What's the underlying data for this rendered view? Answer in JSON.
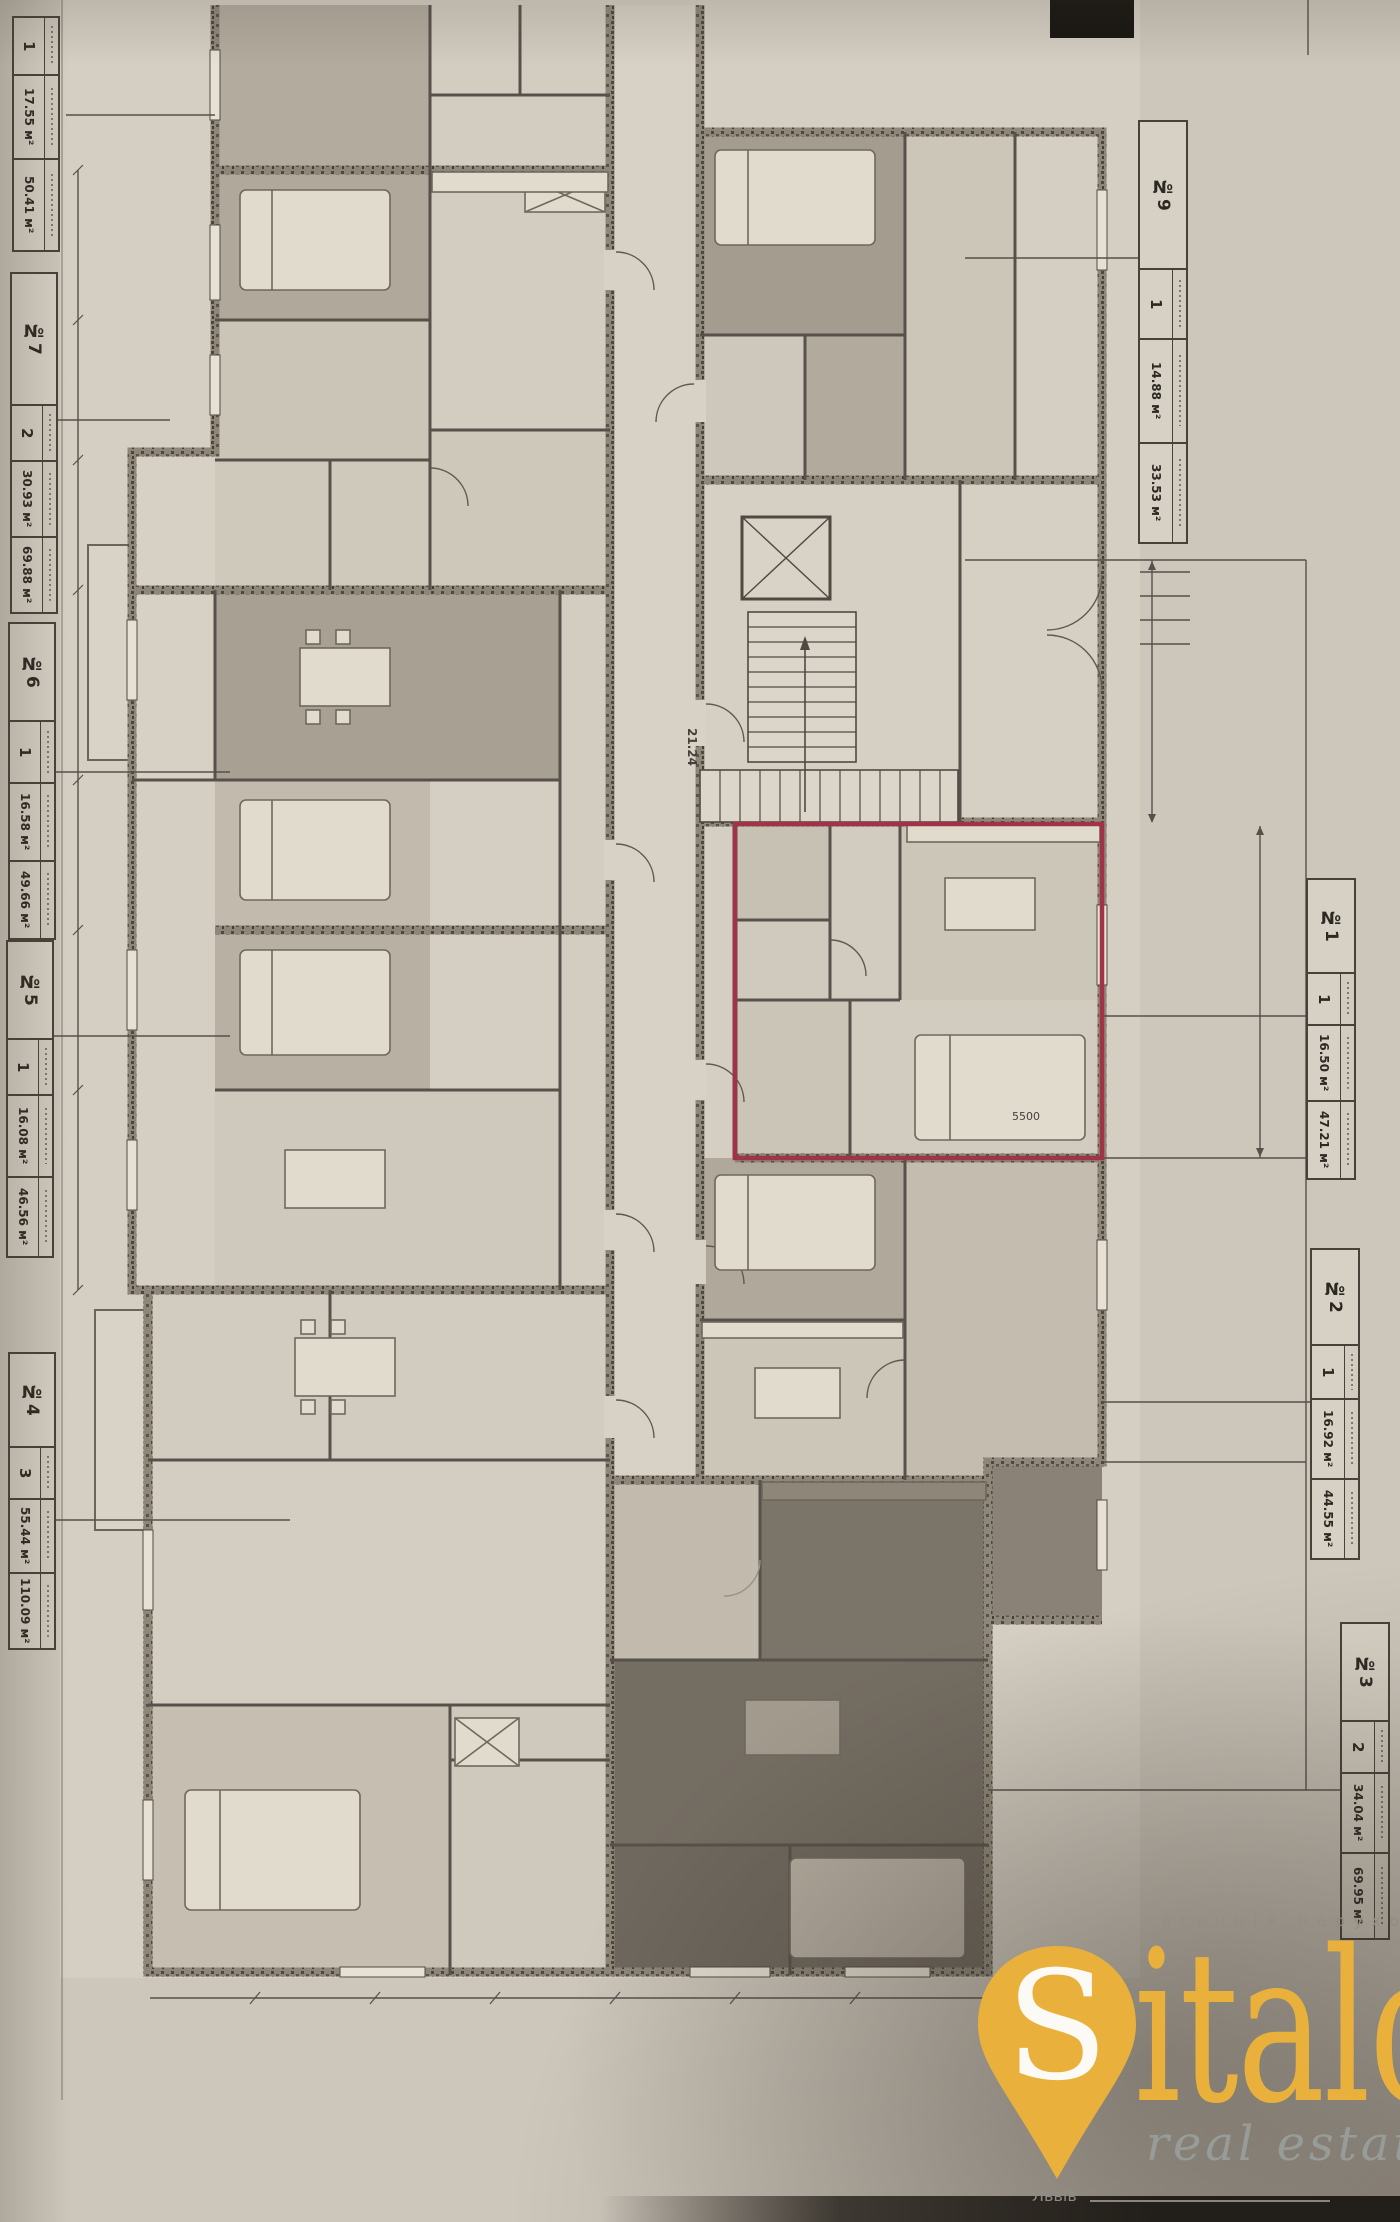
{
  "labels": {
    "left": [
      {
        "id": "",
        "count": "1",
        "area_room": "17.55 м²",
        "area_total": "50.41 м²"
      },
      {
        "id": "№7",
        "count": "2",
        "area_room": "30.93 м²",
        "area_total": "69.88 м²"
      },
      {
        "id": "№6",
        "count": "1",
        "area_room": "16.58 м²",
        "area_total": "49.66 м²"
      },
      {
        "id": "№5",
        "count": "1",
        "area_room": "16.08 м²",
        "area_total": "46.56 м²"
      },
      {
        "id": "№4",
        "count": "3",
        "area_room": "55.44 м²",
        "area_total": "110.09 м²"
      }
    ],
    "right": [
      {
        "id": "№9",
        "count": "1",
        "area_room": "14.88 м²",
        "area_total": "33.53 м²"
      },
      {
        "id": "№1",
        "count": "1",
        "area_room": "16.50 м²",
        "area_total": "47.21 м²"
      },
      {
        "id": "№2",
        "count": "1",
        "area_room": "16.92 м²",
        "area_total": "44.55 м²"
      },
      {
        "id": "№3",
        "count": "2",
        "area_room": "34.04 м²",
        "area_total": "69.95 м²"
      }
    ]
  },
  "plan": {
    "corridor_area": "21.24",
    "dimension_sample": "5500",
    "highlight_color": "#a13347"
  },
  "logo": {
    "brand_initial": "S",
    "brand_rest": "italo",
    "tagline_top": "агенція нерухомості",
    "tagline_bottom": "real estate",
    "city": "Львів",
    "accent_color": "#e9b13c",
    "text_color": "#8f8d88"
  }
}
